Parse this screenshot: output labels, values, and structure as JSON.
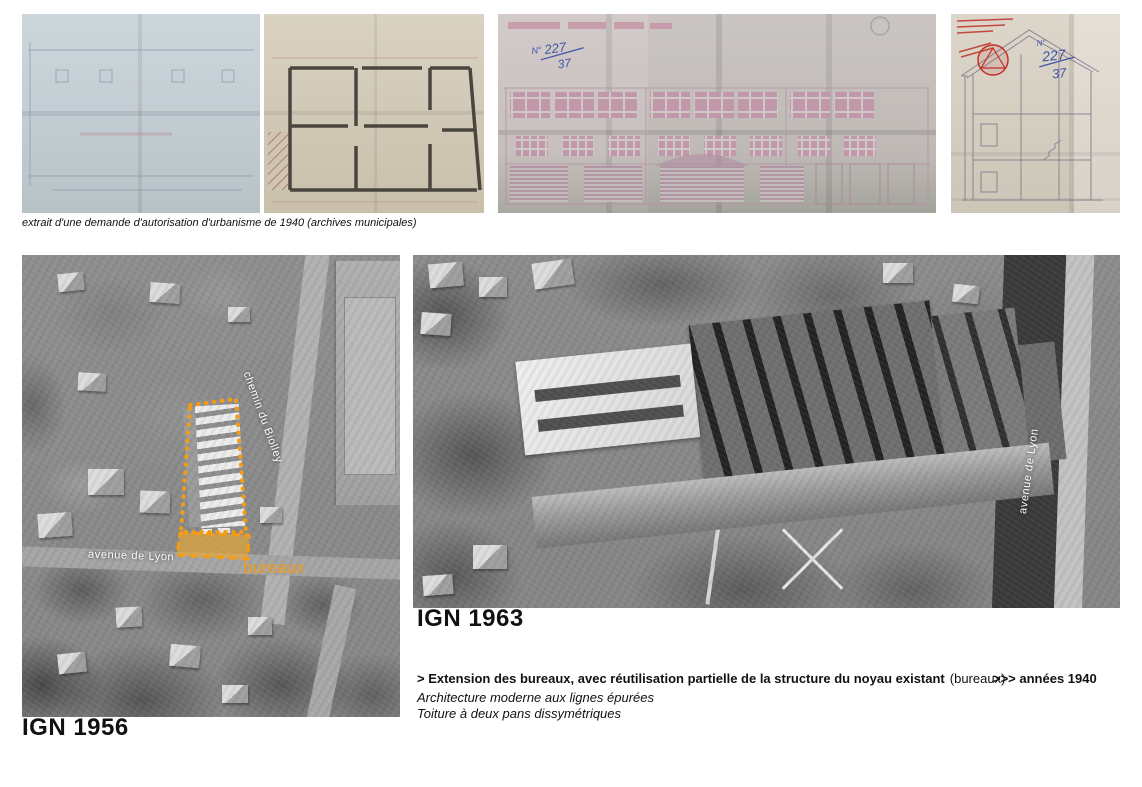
{
  "archival_plans": {
    "caption": "extrait d'une demande d'autorisation d'urbanisme de 1940 (archives municipales)",
    "number_annotation": {
      "prefix": "N°",
      "numerator": "227",
      "denominator": "37"
    },
    "stamp_color": "#c03028",
    "ink_color": "#3f54a6"
  },
  "aerial_1956": {
    "label": "IGN 1956",
    "street_labels": {
      "avenue": "avenue de Lyon",
      "chemin": "chemin du Biolley"
    },
    "zone_label": "bureaux",
    "annotation_color": "#F49C15"
  },
  "aerial_1963": {
    "label": "IGN 1963",
    "street_label": "avenue de Lyon"
  },
  "notes": {
    "line1_bold": "> Extension des bureaux, avec réutilisation partielle de la structure du noyau existant",
    "line1_normal": "(bureaux)",
    "line1_right": ">>> années 1940",
    "line2": "Architecture moderne aux lignes épurées",
    "line3": "Toiture à deux pans dissymétriques"
  }
}
